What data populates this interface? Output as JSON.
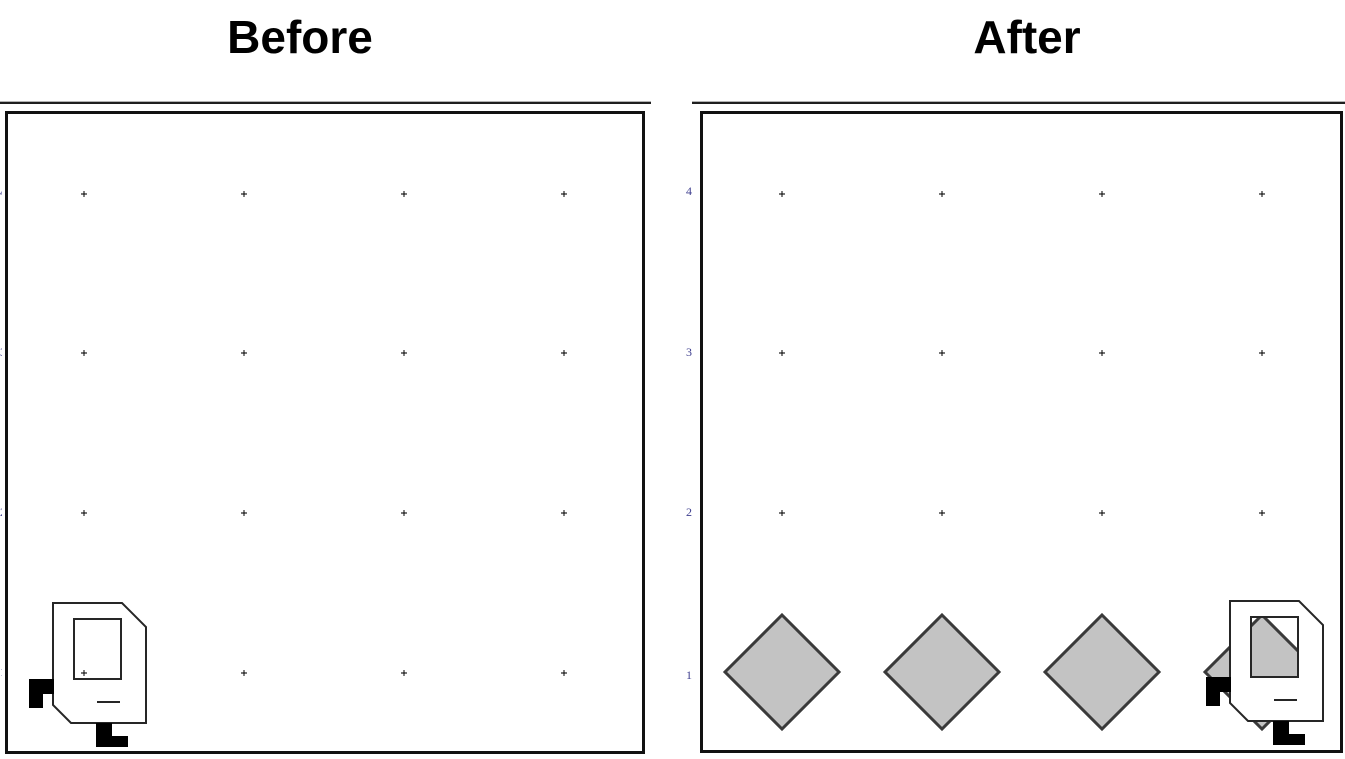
{
  "titles": {
    "before": "Before",
    "after": "After"
  },
  "colors": {
    "diamond_fill": "#c3c3c3",
    "diamond_stroke": "#3a3a3a",
    "icon_outline": "#262626",
    "icon_fill": "#ffffff",
    "feet": "#000000",
    "dot": "#4a4a4a",
    "panel_border": "#111111",
    "axis_label": "#3f3f8f"
  },
  "scene": {
    "grid_rows_y": [
      194,
      353,
      513,
      673
    ],
    "before": {
      "grid_cols_x": [
        84,
        244,
        404,
        564
      ],
      "icon_offset": [
        0,
        0
      ]
    },
    "after": {
      "grid_cols_x": [
        782,
        942,
        1102,
        1262
      ],
      "diamonds": {
        "cx": [
          782,
          942,
          1102,
          1262
        ],
        "cy": 672,
        "half_diagonal": 57
      },
      "icon_offset": [
        1177,
        -2
      ]
    },
    "icon": {
      "body": [
        [
          53,
          603
        ],
        [
          122,
          603
        ],
        [
          146,
          627
        ],
        [
          146,
          723
        ],
        [
          71,
          723
        ],
        [
          53,
          705
        ]
      ],
      "screen": [
        74,
        619,
        47,
        60
      ],
      "slot": [
        97,
        702,
        120,
        702
      ],
      "foot_left": "M29,679 h25 v15 h-11 v14 h-14 Z",
      "foot_bottom": "M96,723 h16 v13 h16 v11 h-32 Z"
    }
  },
  "before_panel": {
    "edge_labels": [
      {
        "label": "4",
        "y": 192
      },
      {
        "label": "3",
        "y": 352
      },
      {
        "label": "2",
        "y": 512
      },
      {
        "label": "1",
        "y": 672
      }
    ]
  },
  "after_panel": {
    "axis_labels": [
      {
        "label": "4",
        "y": 191
      },
      {
        "label": "3",
        "y": 352
      },
      {
        "label": "2",
        "y": 512
      },
      {
        "label": "1",
        "y": 675
      }
    ]
  }
}
